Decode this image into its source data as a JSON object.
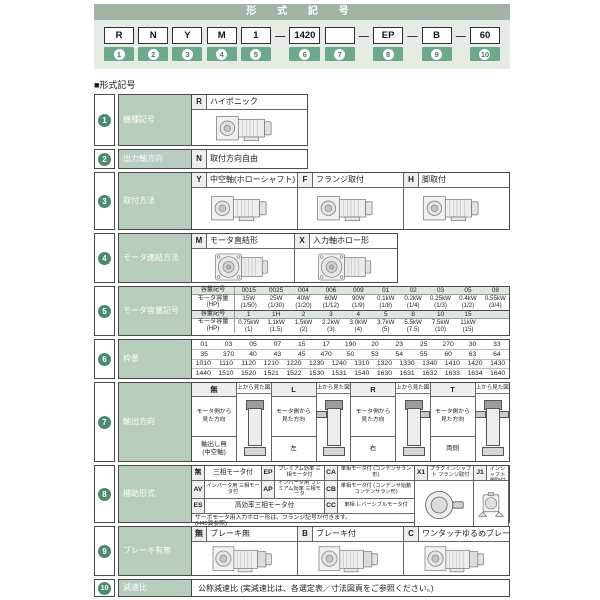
{
  "colors": {
    "band": "#a3b4a6",
    "badge_green": "#6fa98b",
    "circle_green": "#4d8a6b",
    "label_bg": "#b7cdbd",
    "pale_bg": "#e4ece4",
    "code_cell_bg": "#eaf1ea"
  },
  "header": {
    "title": "形 式 記 号",
    "dash": "—",
    "boxes": [
      {
        "label": "R",
        "num": "1"
      },
      {
        "label": "N",
        "num": "2"
      },
      {
        "label": "Y",
        "num": "3"
      },
      {
        "label": "M",
        "num": "4"
      },
      {
        "label": "1",
        "num": "5"
      },
      {
        "label": "1420",
        "num": "6"
      },
      {
        "label": "",
        "num": "7"
      },
      {
        "label": "EP",
        "num": "8"
      },
      {
        "label": "B",
        "num": "9"
      },
      {
        "label": "60",
        "num": "10"
      }
    ]
  },
  "section_label": "■形式記号",
  "r1": {
    "num": "1",
    "label": "機種記号",
    "code": "R",
    "desc": "ハイポニック"
  },
  "r2": {
    "num": "2",
    "label": "出力軸方向",
    "code": "N",
    "desc": "取付方向自由"
  },
  "r3": {
    "num": "3",
    "label": "取付方法",
    "options": [
      {
        "code": "Y",
        "desc": "中空軸(ホローシャフト)"
      },
      {
        "code": "F",
        "desc": "フランジ取付"
      },
      {
        "code": "H",
        "desc": "脚取付"
      }
    ]
  },
  "r4": {
    "num": "4",
    "label": "モータ連結方法",
    "options": [
      {
        "code": "M",
        "desc": "モータ直結形"
      },
      {
        "code": "X",
        "desc": "入力軸ホロー形"
      }
    ]
  },
  "r5": {
    "num": "5",
    "label": "モータ容量記号",
    "head_code": "容量記号",
    "head_cap": "モータ容量",
    "head_hp": "(HP)",
    "sec1_codes": [
      "0015",
      "0025",
      "004",
      "006",
      "009",
      "01",
      "02",
      "03",
      "05",
      "08"
    ],
    "sec1_caps": [
      {
        "w": "15W",
        "hp": "(1/50)"
      },
      {
        "w": "25W",
        "hp": "(1/30)"
      },
      {
        "w": "40W",
        "hp": "(1/20)"
      },
      {
        "w": "60W",
        "hp": "(1/12)"
      },
      {
        "w": "90W",
        "hp": "(1/9)"
      },
      {
        "w": "0.1kW",
        "hp": "(1/8)"
      },
      {
        "w": "0.2kW",
        "hp": "(1/4)"
      },
      {
        "w": "0.25kW",
        "hp": "(1/3)"
      },
      {
        "w": "0.4kW",
        "hp": "(1/2)"
      },
      {
        "w": "0.55kW",
        "hp": "(3/4)"
      }
    ],
    "sec2_codes": [
      "1",
      "1H",
      "2",
      "3",
      "4",
      "5",
      "8",
      "10",
      "15",
      ""
    ],
    "sec2_caps": [
      {
        "w": "0.75kW",
        "hp": "(1)"
      },
      {
        "w": "1.1kW",
        "hp": "(1.5)"
      },
      {
        "w": "1.5kW",
        "hp": "(2)"
      },
      {
        "w": "2.2kW",
        "hp": "(3)"
      },
      {
        "w": "3.0kW",
        "hp": "(4)"
      },
      {
        "w": "3.7kW",
        "hp": "(5)"
      },
      {
        "w": "5.5kW",
        "hp": "(7.5)"
      },
      {
        "w": "7.5kW",
        "hp": "(10)"
      },
      {
        "w": "11kW",
        "hp": "(15)"
      },
      {
        "w": "",
        "hp": ""
      }
    ]
  },
  "r6": {
    "num": "6",
    "label": "枠番",
    "row1": [
      "01",
      "03",
      "05",
      "07",
      "15",
      "17",
      "190",
      "20",
      "23",
      "25",
      "270",
      "30",
      "33"
    ],
    "row2": [
      "35",
      "370",
      "40",
      "43",
      "45",
      "470",
      "50",
      "53",
      "54",
      "55",
      "60",
      "63",
      "64"
    ],
    "row3": [
      "1010",
      "1110",
      "1120",
      "1210",
      "1220",
      "1230",
      "1240",
      "1310",
      "1320",
      "1330",
      "1340",
      "1410",
      "1420",
      "1430"
    ],
    "row4": [
      "1440",
      "1510",
      "1520",
      "1521",
      "1522",
      "1530",
      "1531",
      "1540",
      "1630",
      "1631",
      "1632",
      "1633",
      "1634",
      "1640"
    ]
  },
  "r7": {
    "num": "7",
    "label": "軸出方向",
    "options": [
      {
        "code": "無",
        "top": "上から見た図",
        "view": "モータ側から\n見た方向",
        "dir": "軸出し無",
        "dir2": "(中空軸)",
        "shaft": "none"
      },
      {
        "code": "L",
        "top": "上から見た図",
        "view": "モータ側から\n見た方向",
        "dir": "左",
        "dir2": "",
        "shaft": "left"
      },
      {
        "code": "R",
        "top": "上から見た図",
        "view": "モータ側から\n見た方向",
        "dir": "右",
        "dir2": "",
        "shaft": "right"
      },
      {
        "code": "T",
        "top": "上から見た図",
        "view": "モータ側から\n見た方向",
        "dir": "両側",
        "dir2": "",
        "shaft": "both"
      }
    ]
  },
  "r8": {
    "num": "8",
    "label": "補助形式",
    "c1": {
      "code": "無",
      "desc": "三相モータ付"
    },
    "c2": {
      "code": "EP",
      "desc": "プレミアム効率 三相モータ付"
    },
    "c3": {
      "code": "CA",
      "desc": "単相モータ付 (コンデンサラン形)"
    },
    "c4": {
      "code": "X1",
      "desc": "プラグインシャフト フランジ取付"
    },
    "c5": {
      "code": "J1",
      "desc": "プラグインシャフト 脚取付"
    },
    "c6": {
      "code": "AV",
      "desc": "インバータ用 三相モータ付"
    },
    "c7": {
      "code": "AP",
      "desc": "インバータ用 プレミアム効率 三相モータ"
    },
    "c8": {
      "code": "CB",
      "desc": "単相モータ付 (コンデンサ始動コンデンサラン形)"
    },
    "c9": {
      "code": "ES",
      "desc": "高効率三相モータ付"
    },
    "c10": {
      "code": "CC",
      "desc": "単相 レバーシブルモータ付"
    },
    "note1": "サーボモータ用入力ホロー形は、フランジ記号が付きます。",
    "note2": "(H40頁参照)"
  },
  "r9": {
    "num": "9",
    "label": "ブレーキ有無",
    "options": [
      {
        "code": "無",
        "desc": "ブレーキ無"
      },
      {
        "code": "B",
        "desc": "ブレーキ付"
      },
      {
        "code": "C",
        "desc": "ワンタッチゆるめブレーキ付"
      }
    ]
  },
  "r10": {
    "num": "10",
    "label": "減速比",
    "desc": "公称減速比 (実減速比は、各選定表／寸法図頁をご参照ください。)"
  }
}
